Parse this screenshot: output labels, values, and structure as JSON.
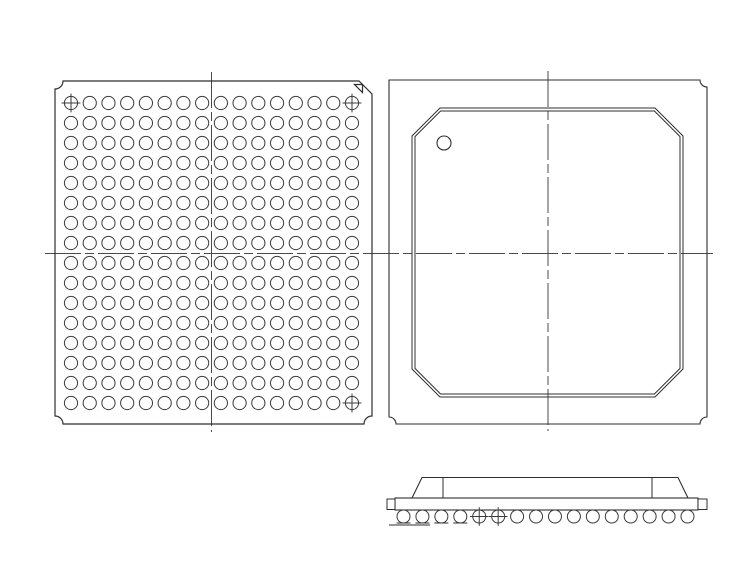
{
  "document": {
    "kind": "bga-package-mechanical-drawing",
    "views": [
      "bottom-view-ball-grid",
      "top-view-package-body",
      "side-view-profile"
    ]
  },
  "colors": {
    "background": "#ffffff",
    "line": "#2f2f2f",
    "ball_stroke": "#3a3a3a",
    "centerline": "#4a4a4a",
    "marker_fill": "#ffffff"
  },
  "centerline_dash": "36 4 9 4",
  "h_centerline": {
    "x1": 45,
    "x2": 713,
    "y": 253.5
  },
  "bottom_view": {
    "outline": {
      "x1": 55,
      "y1": 81,
      "x2": 372,
      "y2": 424,
      "notch_radius": 8,
      "pin1_chamfer": 13
    },
    "pin1_triangle": {
      "points": "354.5,84.5 362.5,84.5 362.5,92.5"
    },
    "balls": {
      "rows": 16,
      "cols": 16,
      "count": 256,
      "cx0": 71,
      "cy0": 103,
      "pitch_x": 18.733,
      "pitch_y": 20,
      "radius": 6.6,
      "crosshair_cells": [
        [
          1,
          1
        ],
        [
          1,
          16
        ],
        [
          16,
          16
        ]
      ],
      "crosshair_overhang": 2.8
    },
    "v_centerline": {
      "x": 211.5,
      "y1": 72,
      "y2": 432
    }
  },
  "top_view": {
    "outline": {
      "x1": 389,
      "y1": 80,
      "x2": 707,
      "y2": 424,
      "notch_radius": 7
    },
    "body_outer": {
      "x1": 412,
      "y1": 108,
      "x2": 683,
      "y2": 397,
      "chamfer": 28
    },
    "body_inner_offset": 3,
    "pin1_marker": {
      "cx": 444,
      "cy": 143,
      "r": 7
    },
    "v_centerline": {
      "x": 548,
      "y1": 71,
      "y2": 431
    }
  },
  "side_view": {
    "substrate": {
      "x1": 395,
      "y1": 498,
      "x2": 698,
      "y2": 510
    },
    "left_cap": {
      "x1": 387,
      "y1": 499,
      "x2": 395,
      "y2": 509.5
    },
    "right_cap": {
      "x1": 698,
      "y1": 499,
      "x2": 707,
      "y2": 509.5
    },
    "mold": {
      "base_y": 498,
      "top_y": 477.5,
      "slant_bl_x": 412,
      "slant_tl_x": 422,
      "slant_tr_x": 678,
      "slant_br_x": 688,
      "edge_left_x": 443,
      "edge_right_x": 652
    },
    "balls": {
      "count": 16,
      "cx0": 403.5,
      "pitch": 18.933,
      "cy": 516.5,
      "radius": 6.5,
      "crosshair_indices": [
        5,
        6
      ],
      "crosshair_overhang": 2.8
    },
    "seating_ticks": {
      "ball_indices": [
        1,
        2,
        3,
        4
      ],
      "y": 523,
      "half_width": 7
    },
    "seating_line": {
      "x1": 389,
      "y": 525,
      "x2": 430
    }
  }
}
